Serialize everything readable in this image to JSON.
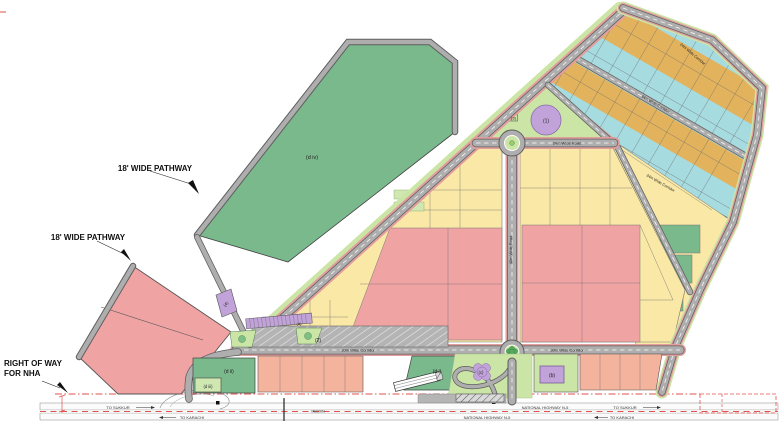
{
  "annotations": {
    "pathway_label_1": "18' WIDE PATHWAY",
    "pathway_label_2": "18' WIDE PATHWAY",
    "row_label_line1": "RIGHT OF WAY",
    "row_label_line2": "FOR NHA"
  },
  "road_labels": {
    "wide_road_24m": "24m Wide Road",
    "wide_road_40m": "40m Wide Road",
    "corridor_30m_left": "30m Wide Corridor",
    "corridor_30m_right": "30m Wide Corridor",
    "corridor_24m_1": "24m Wide Corridor",
    "corridor_24m_2": "24m Wide Corridor",
    "corridor_24m_3": "24m Wide Corridor"
  },
  "parcel_labels": {
    "p1": "(1)",
    "p2": "(2)",
    "p3": "(3)",
    "p4": "(4)",
    "pa": "(a)",
    "pb": "(b)",
    "pc": "(c)",
    "pd_i": "(d i)",
    "pd_ii": "(d ii)",
    "pd_iii": "(d iii)",
    "pd_iv": "(d iv)"
  },
  "highway": {
    "name": "NATIONAL HIGHWAY N-5",
    "to_sukkur": "TO SUKKUR",
    "to_karachi": "TO KARACHI",
    "median": "MEDIAN"
  },
  "colors": {
    "parcel_green": "#79b98c",
    "parcel_light_green_lot": "#cfe7b0",
    "parcel_pink": "#f0a3a3",
    "parcel_salmon": "#f4b39d",
    "parcel_yellow": "#fae8a6",
    "parcel_cyan": "#a6dbe0",
    "parcel_orange": "#e2b35c",
    "parcel_purple": "#c2a3d9",
    "park_green": "#cbe5a6",
    "island_tree_green": "#7fbe84",
    "star_green": "#55a85e",
    "road_gray": "#aeaeae",
    "parking_gray": "#b4b4b4",
    "row_red": "#e0524f"
  }
}
